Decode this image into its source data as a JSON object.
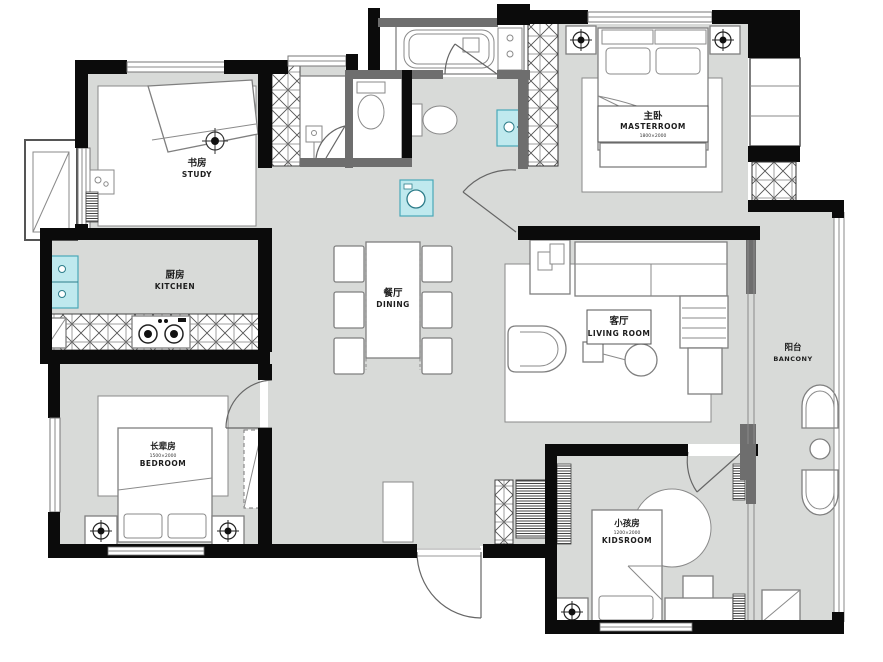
{
  "title": "apartment-floor-plan",
  "colors": {
    "floor_gray": "#d8dad8",
    "wall_black": "#0b0b0b",
    "wall_gray": "#6e6e6e",
    "fixture_cyan": "#bfe9ee",
    "line_gray": "#7f7f7f",
    "paper": "#ffffff"
  },
  "rooms": {
    "study": {
      "zh": "书房",
      "en": "STUDY"
    },
    "kitchen": {
      "zh": "厨房",
      "en": "KITCHEN"
    },
    "dining": {
      "zh": "餐厅",
      "en": "DINING"
    },
    "master": {
      "zh": "主卧",
      "en": "MASTERROOM",
      "dim": "1800×2000"
    },
    "living": {
      "zh": "客厅",
      "en": "LIVING ROOM"
    },
    "balcony": {
      "zh": "阳台",
      "en": "BANCONY"
    },
    "elder": {
      "zh": "长辈房",
      "en": "BEDROOM",
      "dim": "1500×2000"
    },
    "kids": {
      "zh": "小孩房",
      "en": "KIDSROOM",
      "dim": "1200×2000"
    }
  }
}
